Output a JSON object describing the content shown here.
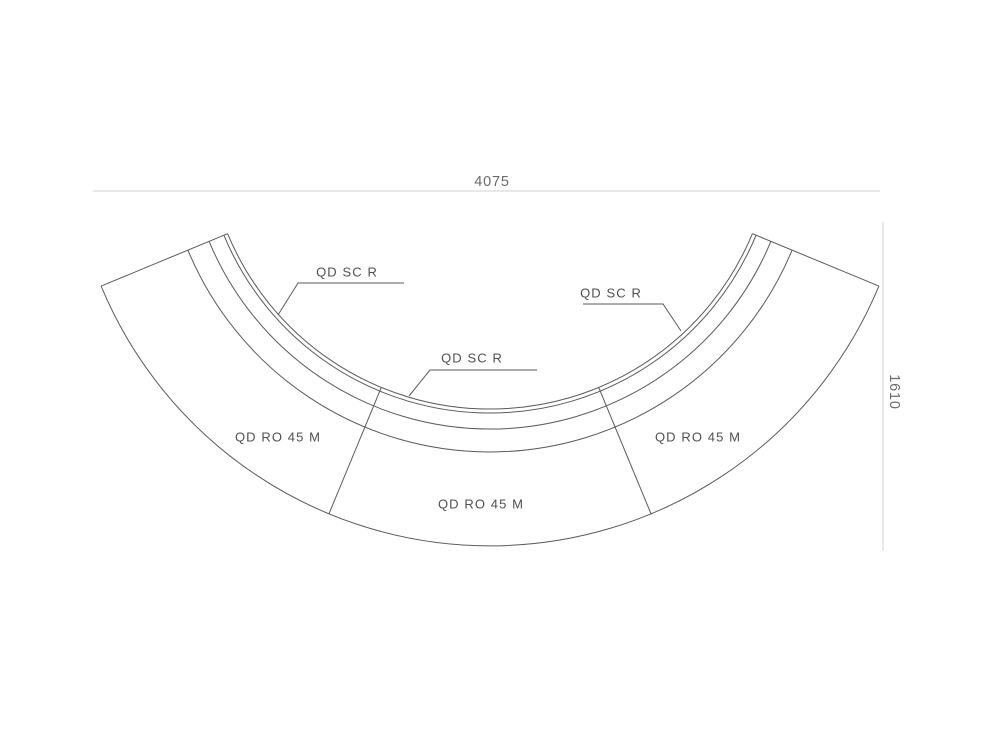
{
  "drawing": {
    "type": "product-dimension-diagram",
    "dimensions": {
      "width": "4075",
      "depth": "1610"
    },
    "screen_labels": [
      {
        "label": "QD SC R"
      },
      {
        "label": "QD SC R"
      },
      {
        "label": "QD SC R"
      }
    ],
    "module_labels": [
      {
        "label": "QD RO 45 M"
      },
      {
        "label": "QD RO 45 M"
      },
      {
        "label": "QD RO 45 M"
      }
    ],
    "colors": {
      "background": "#ffffff",
      "line": "#5a5a5a",
      "dimension_line": "#d9d9d9",
      "dimension_text": "#6a6a6a",
      "label_text": "#4f4f4f"
    }
  }
}
